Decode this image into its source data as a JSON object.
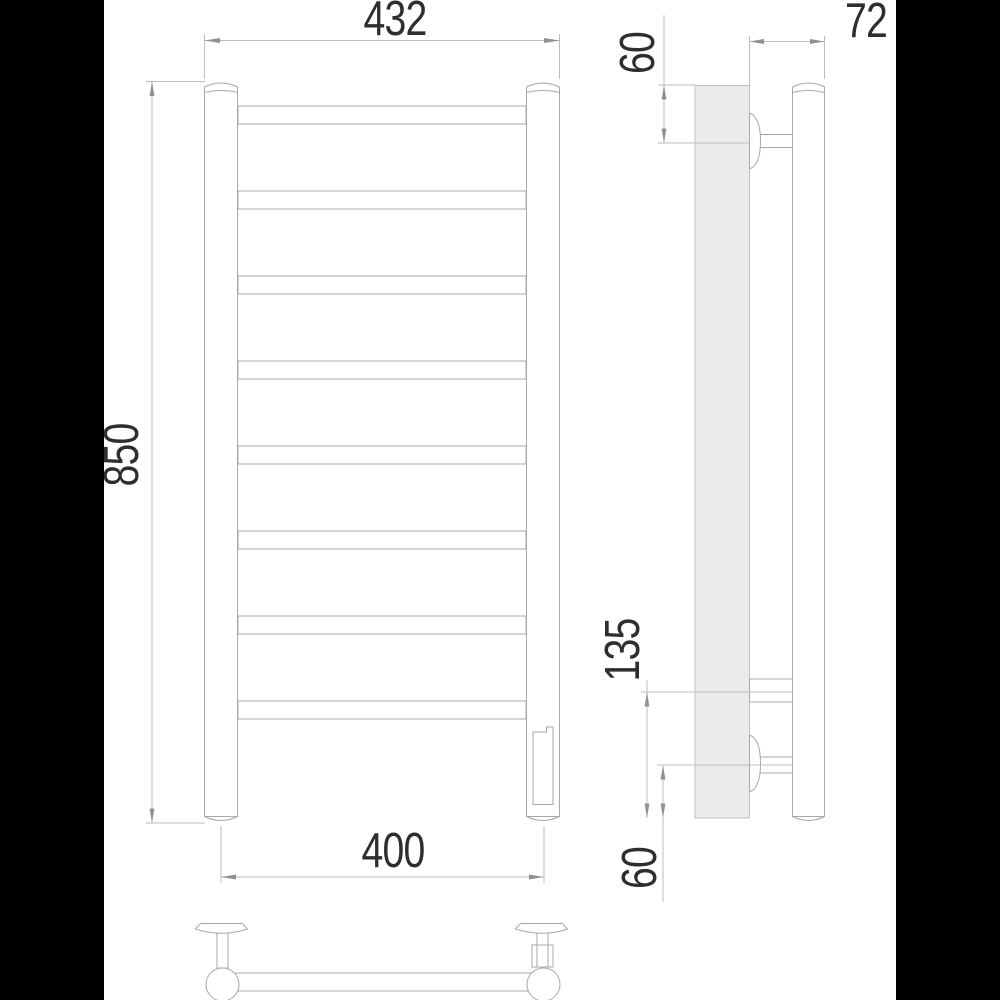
{
  "views": {
    "front": {
      "overall_width_label": "432",
      "overall_height_label": "850",
      "rail_axis_width_label": "400",
      "rung_count": 8
    },
    "side": {
      "depth_label": "72",
      "top_bracket_offset_label": "60",
      "bottom_section_label": "135",
      "bottom_bracket_offset_label": "60"
    },
    "top": {
      "bracket_count": 2
    }
  },
  "colors": {
    "background": "#ffffff",
    "side_bars": "#010101",
    "outline": "#a8a8a8",
    "dimension_lines": "#bcbcbc",
    "wall_fill": "#ebebeb",
    "text": "#2e2e2e"
  }
}
